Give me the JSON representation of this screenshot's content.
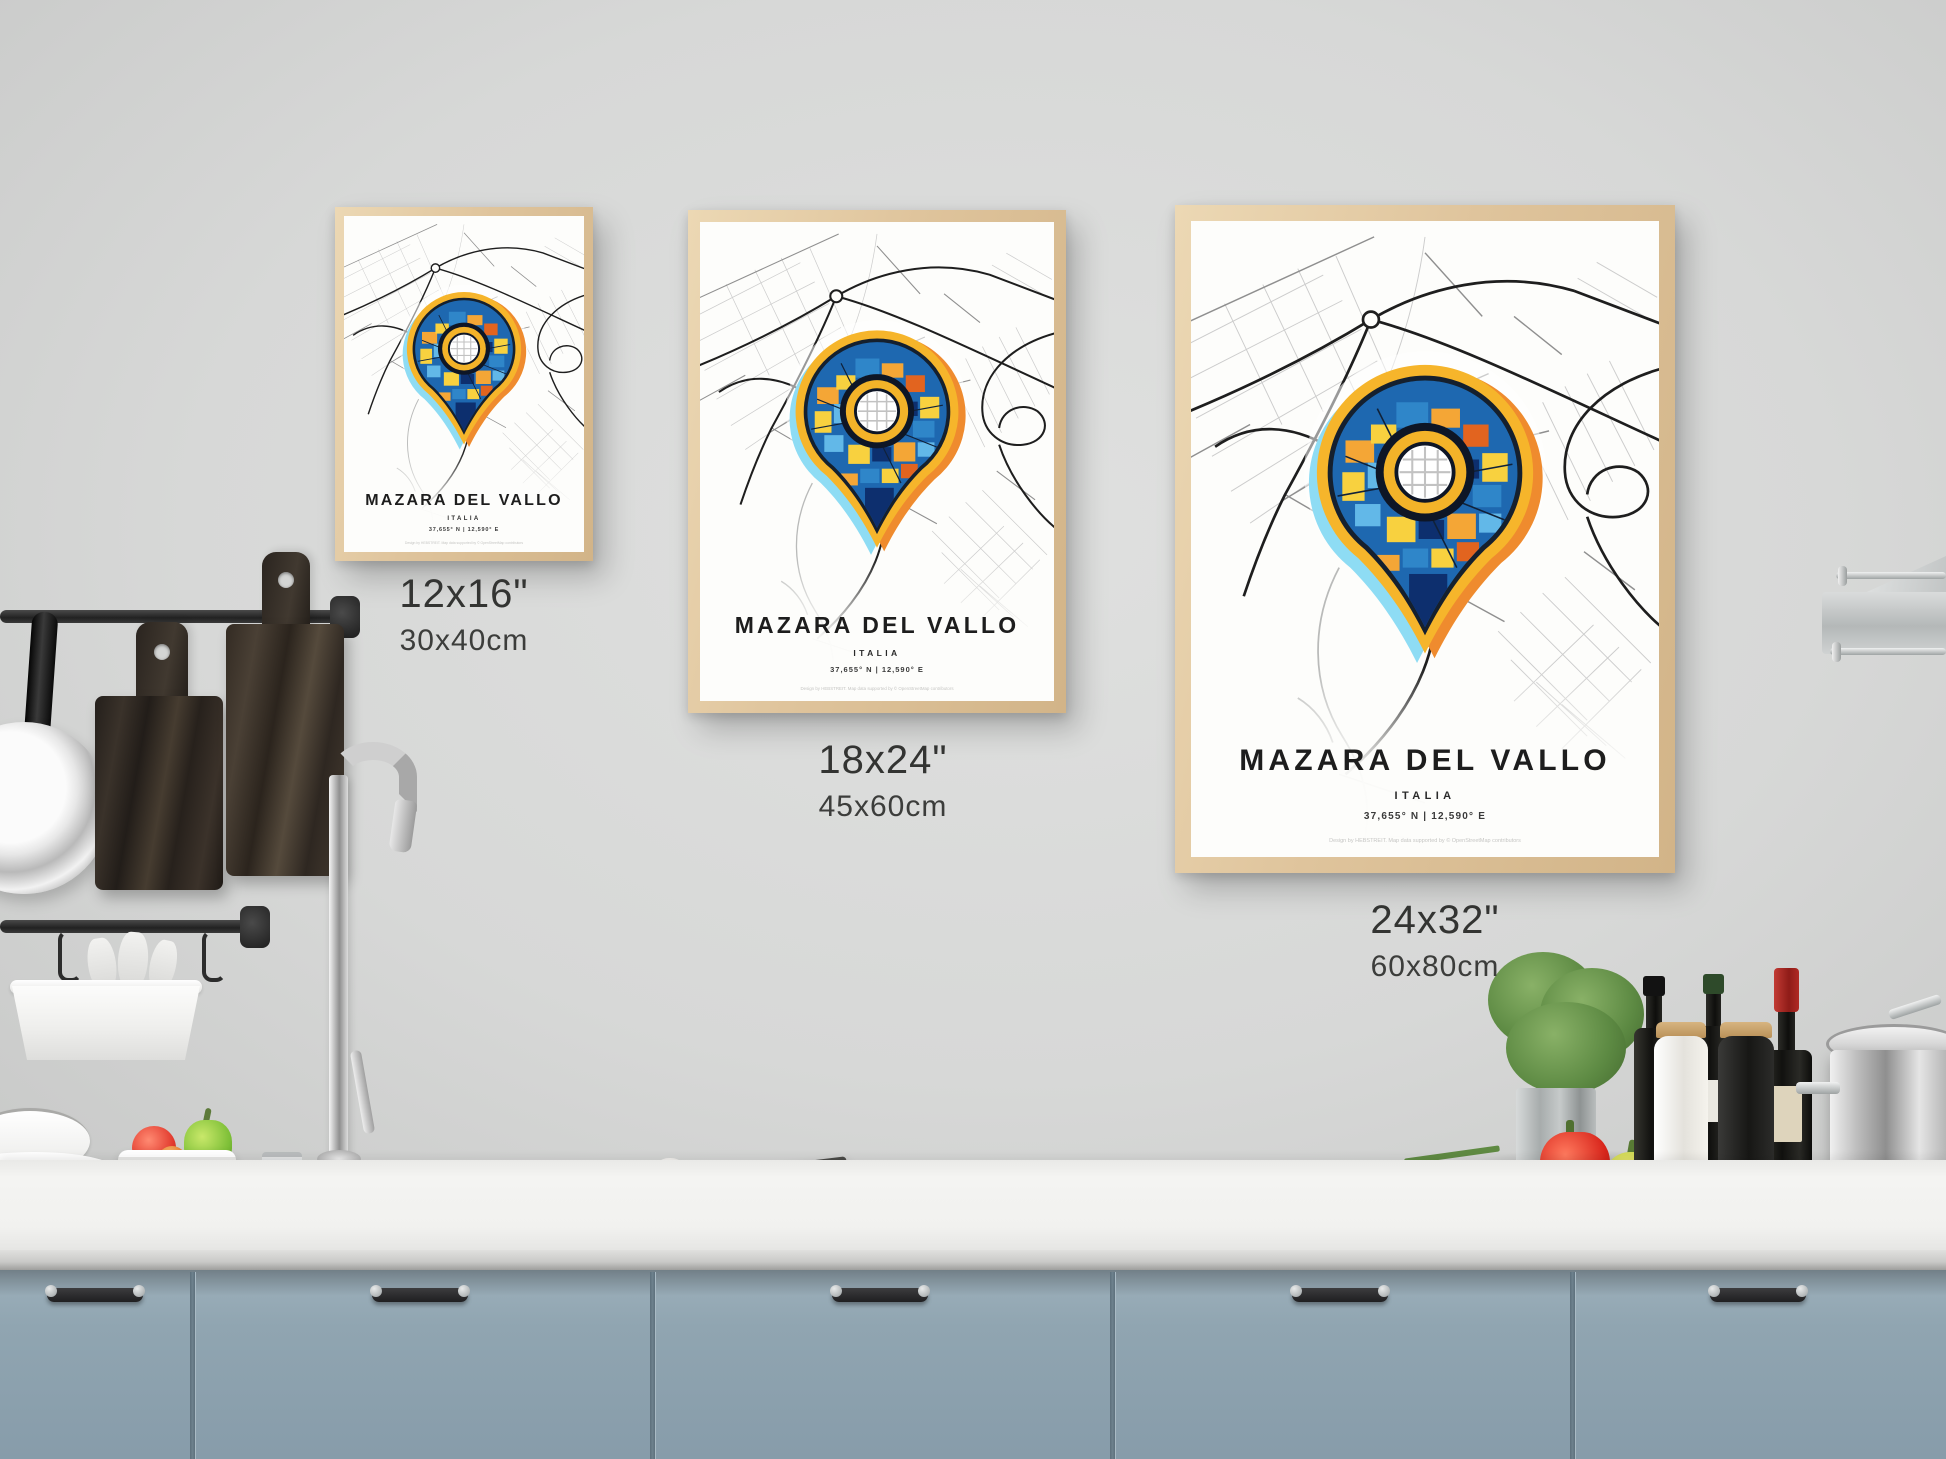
{
  "poster": {
    "title": "MAZARA DEL VALLO",
    "subtitle": "ITALIA",
    "coordinates": "37,655° N | 12,590° E",
    "credit": "Design by HEBSTREIT. Map data supported by © OpenStreetMap contributors"
  },
  "size_labels": [
    {
      "inches": "12x16\"",
      "cm": "30x40cm"
    },
    {
      "inches": "18x24\"",
      "cm": "45x60cm"
    },
    {
      "inches": "24x32\"",
      "cm": "60x80cm"
    }
  ],
  "colors": {
    "wall": "#d7d8d7",
    "counter": "#f2f2f0",
    "cabinet": "#90a5b1",
    "frame_wood": "#dfc49c",
    "pin_yellow": "#f6b52b",
    "pin_cyan": "#8edcf4",
    "pin_orange": "#ef8b2e",
    "pin_navy": "#0d2f6e",
    "pin_blue": "#1e68b0",
    "map_road_dark": "#1e1e1e",
    "map_road_gray": "#8f8f8f"
  }
}
